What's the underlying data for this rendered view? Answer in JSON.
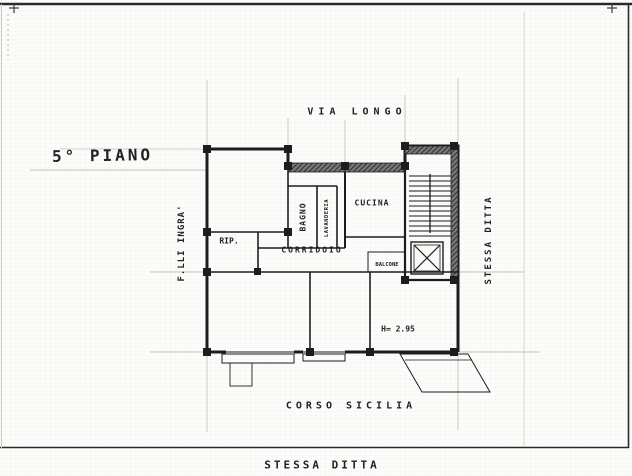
{
  "sheet": {
    "floor_label": "5° PIANO",
    "street_top": "VIA LONGO",
    "street_bottom": "CORSO SICILIA",
    "neighbor_bottom": "STESSA DITTA",
    "neighbor_right": "STESSA DITTA",
    "neighbor_left": "F.LLI INGRA'"
  },
  "rooms": {
    "bagno": "BAGNO",
    "lavanderia": "LAVANDERIA",
    "cucina": "CUCINA",
    "rip": "RIP.",
    "corridoio": "CORRIDOIO",
    "balcone": "BALCONE",
    "height_note": "H= 2.95"
  },
  "colors": {
    "paper": "#fcfcfa",
    "ink": "#1d1d1d",
    "faint_line": "#c3c3bd"
  }
}
